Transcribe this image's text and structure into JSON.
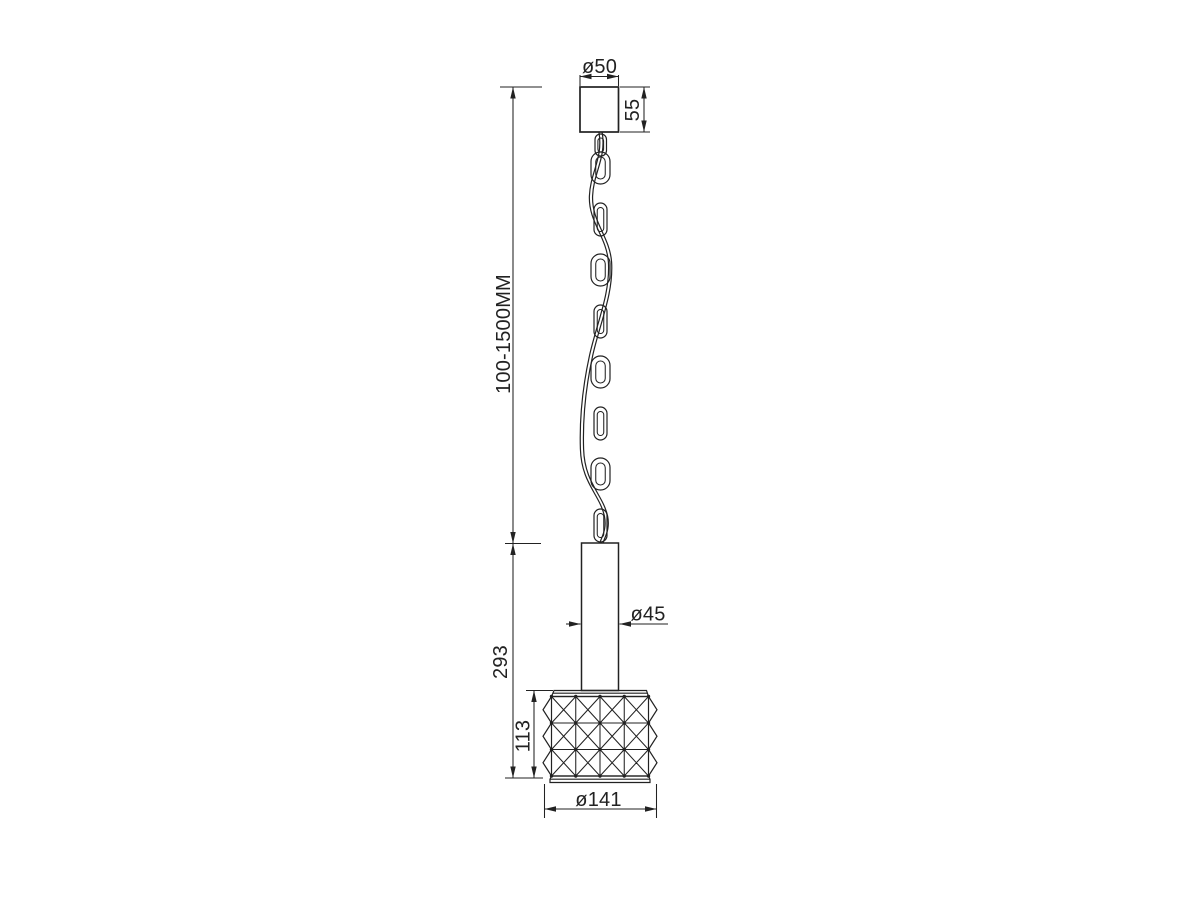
{
  "drawing": {
    "kind": "pendant-lamp-dimension-drawing",
    "dimensions": {
      "canopy_diameter": "ø50",
      "canopy_height": "55",
      "suspension_length": "100-1500MM",
      "stem_diameter": "ø45",
      "body_height": "293",
      "shade_height": "113",
      "shade_diameter": "ø141"
    },
    "colors": {
      "line": "#222222",
      "background": "#ffffff"
    }
  }
}
